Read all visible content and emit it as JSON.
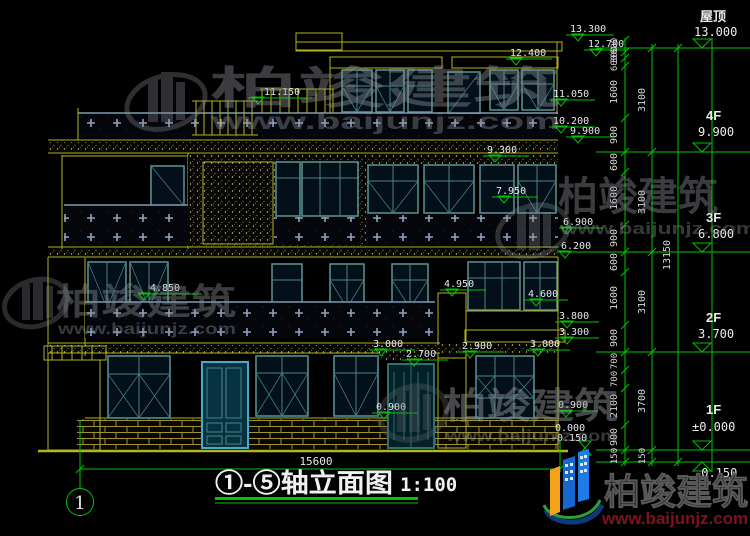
{
  "title_block": {
    "title": "①-⑤轴立面图",
    "scale": "1:100"
  },
  "axis": {
    "bubble": "1",
    "width_dim": "15600"
  },
  "levels": {
    "roof": {
      "label": "屋顶",
      "elev": "13.000"
    },
    "f4": {
      "label": "4F",
      "elev": "9.900"
    },
    "f3": {
      "label": "3F",
      "elev": "6.800"
    },
    "f2": {
      "label": "2F",
      "elev": "3.700"
    },
    "f1": {
      "label": "1F",
      "elev": "±0.000"
    },
    "base": {
      "elev": "-0.150"
    }
  },
  "dims": {
    "fine": [
      "600",
      "300",
      "600",
      "1600",
      "900",
      "600",
      "1600",
      "900",
      "600",
      "1600",
      "900",
      "700",
      "700",
      "2100",
      "900",
      "150"
    ],
    "floors": [
      "3100",
      "3100",
      "3100",
      "3700",
      "150"
    ],
    "total": "13150"
  },
  "marks": {
    "a13300": "13.300",
    "a12700": "12.700",
    "a12400": "12.400",
    "a11150": "11.150",
    "a11050": "11.050",
    "a10200": "10.200",
    "a9900": "9.900",
    "a9300": "9.300",
    "a7950": "7.950",
    "a6900": "6.900",
    "a6200": "6.200",
    "a4850": "4.850",
    "a4950": "4.950",
    "a4600": "4.600",
    "a3800": "3.800",
    "a3300": "3.300",
    "a3000L": "3.000",
    "a2900": "2.900",
    "a2700": "2.700",
    "a3000R": "3.000",
    "a0900L": "0.900",
    "a0900R": "0.900",
    "a0000": "0.000",
    "aNeg0150": "-0.150"
  },
  "watermark": {
    "brand": "柏竣建筑",
    "site": "www.baijunjz.com"
  },
  "logo": {
    "brand": "柏竣建筑",
    "site": "www.baijunjz.com"
  },
  "colors": {
    "cad_yellow": "#b4b41e",
    "cad_green": "#00c400",
    "frame_teal": "#5d9494",
    "logo_blue": "#1668cf",
    "logo_orange": "#f5a21b",
    "logo_red": "#7d1321"
  }
}
